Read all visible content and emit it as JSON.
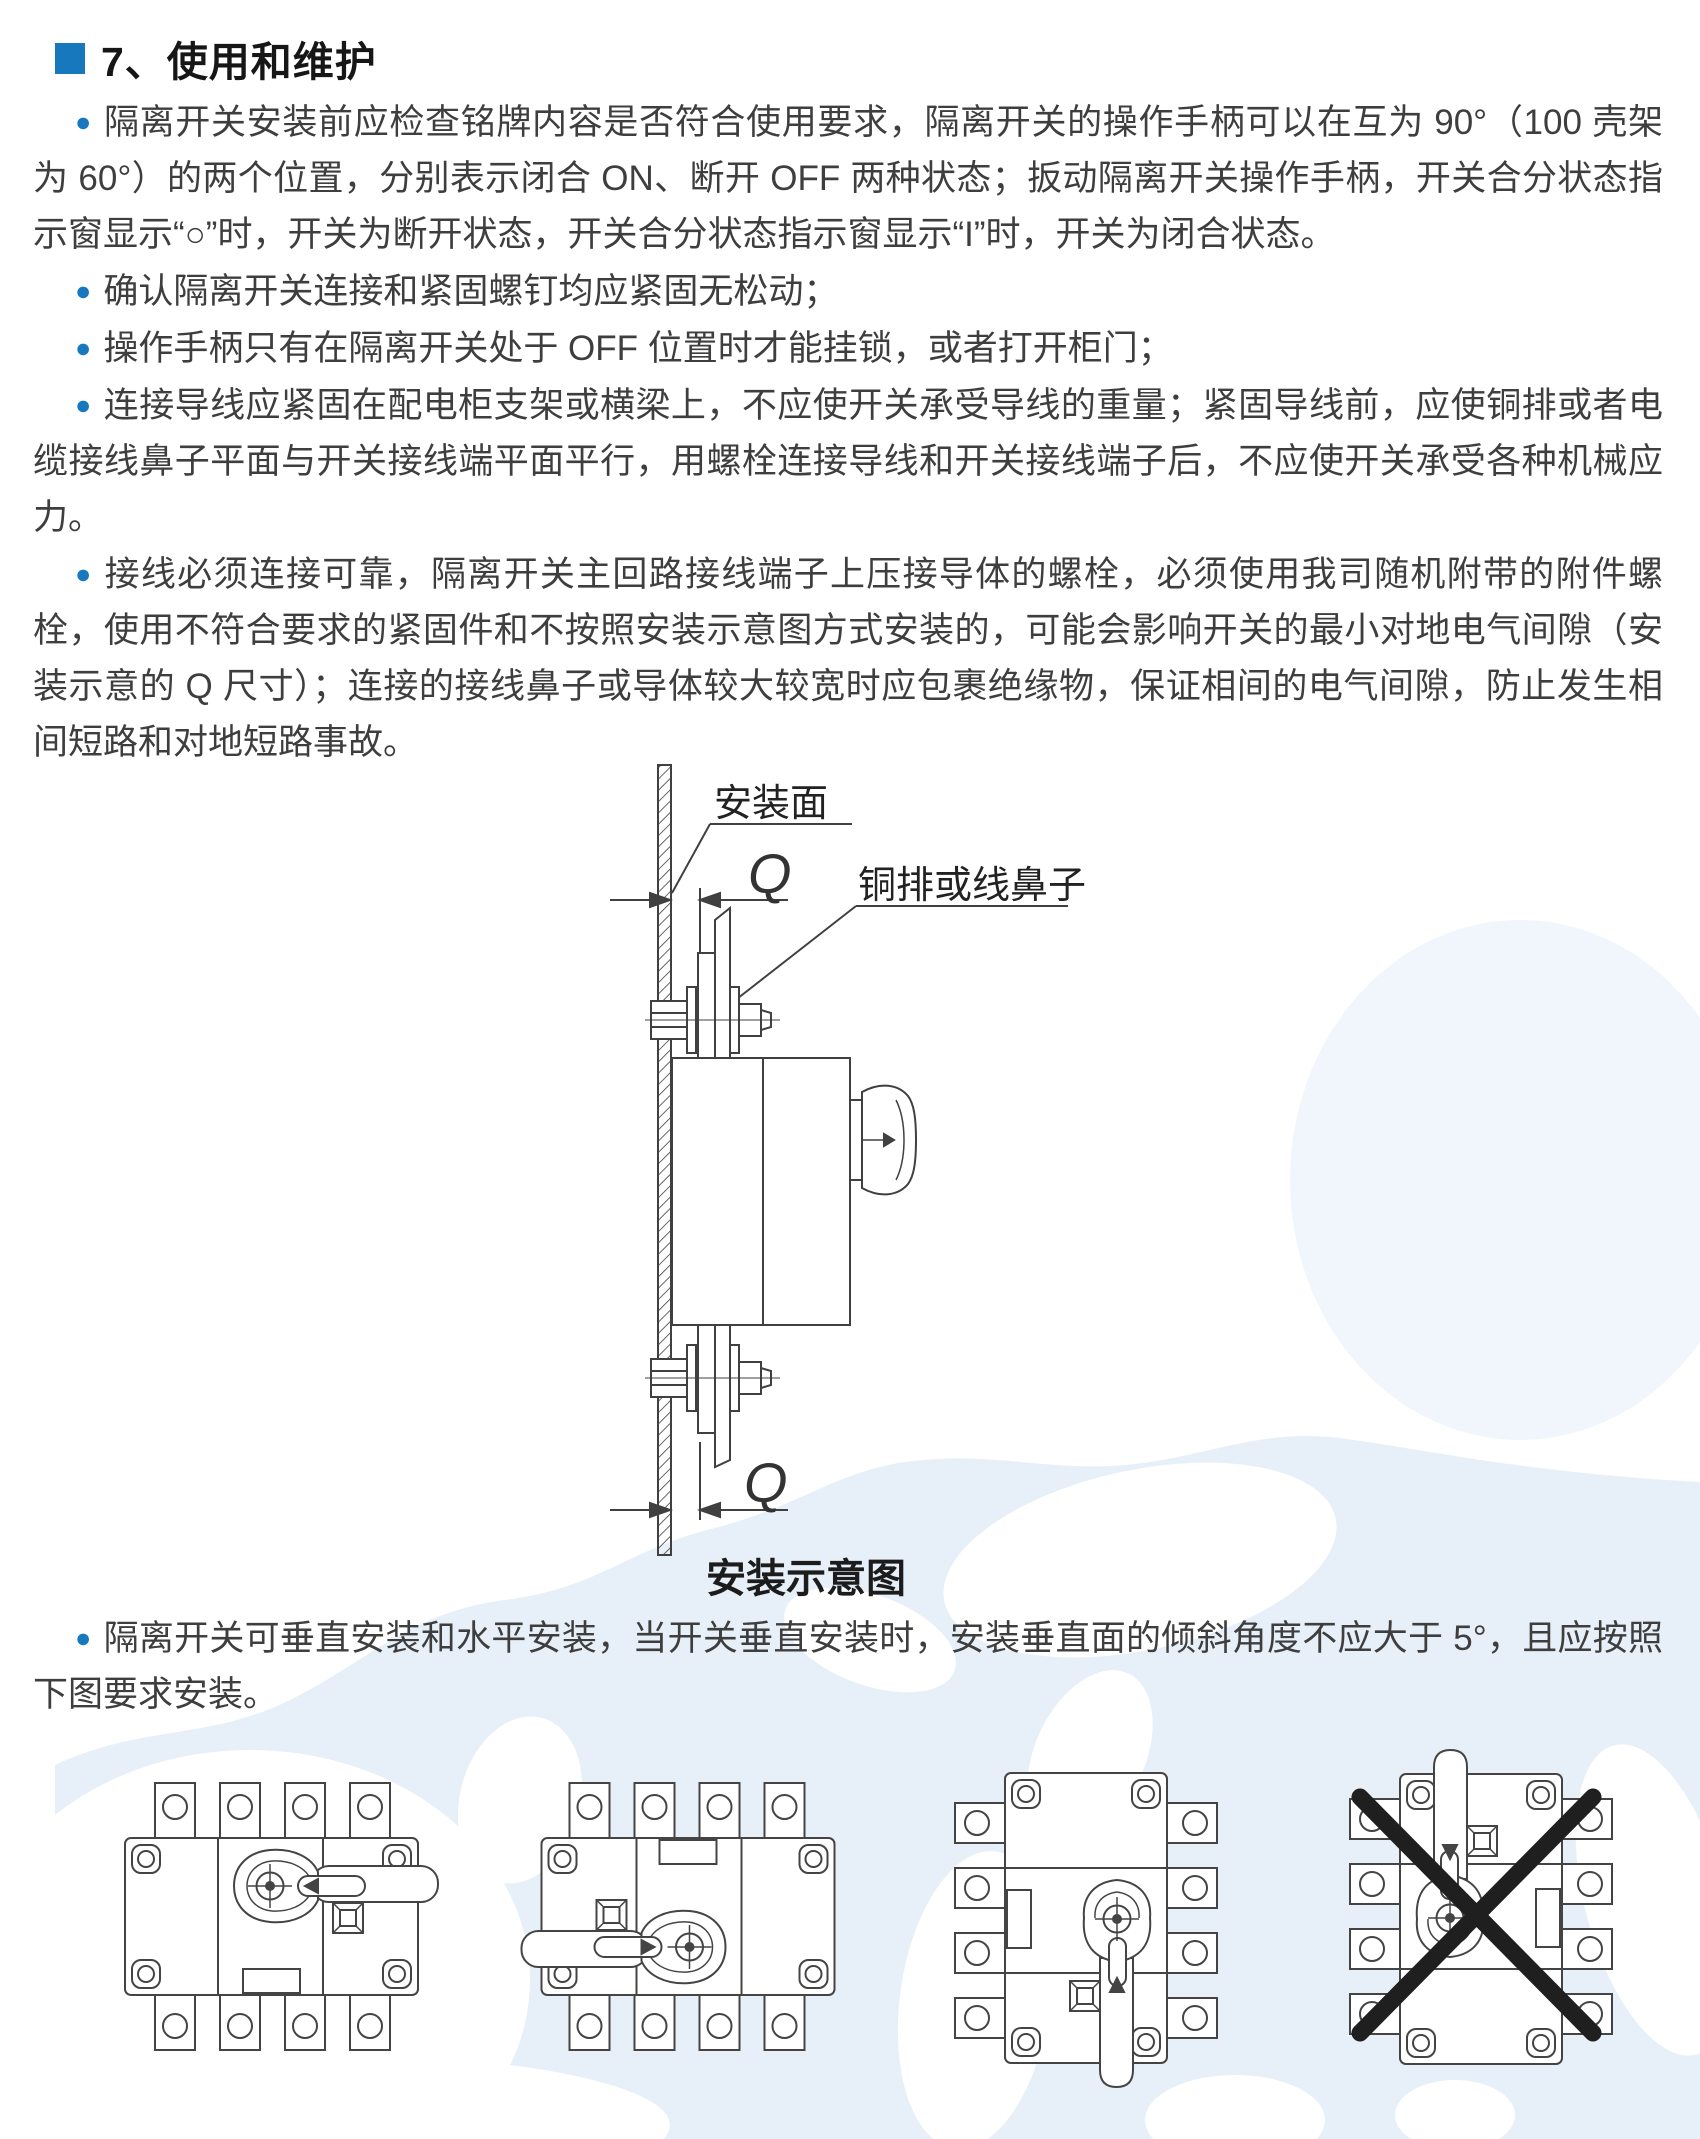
{
  "colors": {
    "accent": "#1878be",
    "body_text": "#3e3e3e",
    "title_text": "#161616",
    "line_work": "#404040",
    "watermark_sea": "#e7f0f9",
    "watermark_faint": "#f0f6fc",
    "prohibition_cross": "#1f1f1f"
  },
  "header": {
    "title": "7、使用和维护"
  },
  "paragraphs": [
    {
      "bullet": "●",
      "text": "隔离开关安装前应检查铭牌内容是否符合使用要求，隔离开关的操作手柄可以在互为 90°（100 壳架为 60°）的两个位置，分别表示闭合 ON、断开 OFF 两种状态；扳动隔离开关操作手柄，开关合分状态指示窗显示“○”时，开关为断开状态，开关合分状态指示窗显示“I”时，开关为闭合状态。"
    },
    {
      "bullet": "●",
      "text": "确认隔离开关连接和紧固螺钉均应紧固无松动；"
    },
    {
      "bullet": "●",
      "text": "操作手柄只有在隔离开关处于 OFF 位置时才能挂锁，或者打开柜门；"
    },
    {
      "bullet": "●",
      "text": "连接导线应紧固在配电柜支架或横梁上，不应使开关承受导线的重量；紧固导线前，应使铜排或者电缆接线鼻子平面与开关接线端平面平行，用螺栓连接导线和开关接线端子后，不应使开关承受各种机械应力。"
    },
    {
      "bullet": "●",
      "text": "接线必须连接可靠，隔离开关主回路接线端子上压接导体的螺栓，必须使用我司随机附带的附件螺栓，使用不符合要求的紧固件和不按照安装示意图方式安装的，可能会影响开关的最小对地电气间隙（安装示意的 Q 尺寸）；连接的接线鼻子或导体较大较宽时应包裹绝缘物，保证相间的电气间隙，防止发生相间短路和对地短路事故。"
    },
    {
      "bullet": "●",
      "text": "隔离开关可垂直安装和水平安装，当开关垂直安装时，安装垂直面的倾斜角度不应大于 5°，且应按照下图要求安装。"
    }
  ],
  "diagram": {
    "mounting_surface_label": "安装面",
    "busbar_label": "铜排或线鼻子",
    "dimension_symbol": "Q",
    "caption": "安装示意图"
  }
}
